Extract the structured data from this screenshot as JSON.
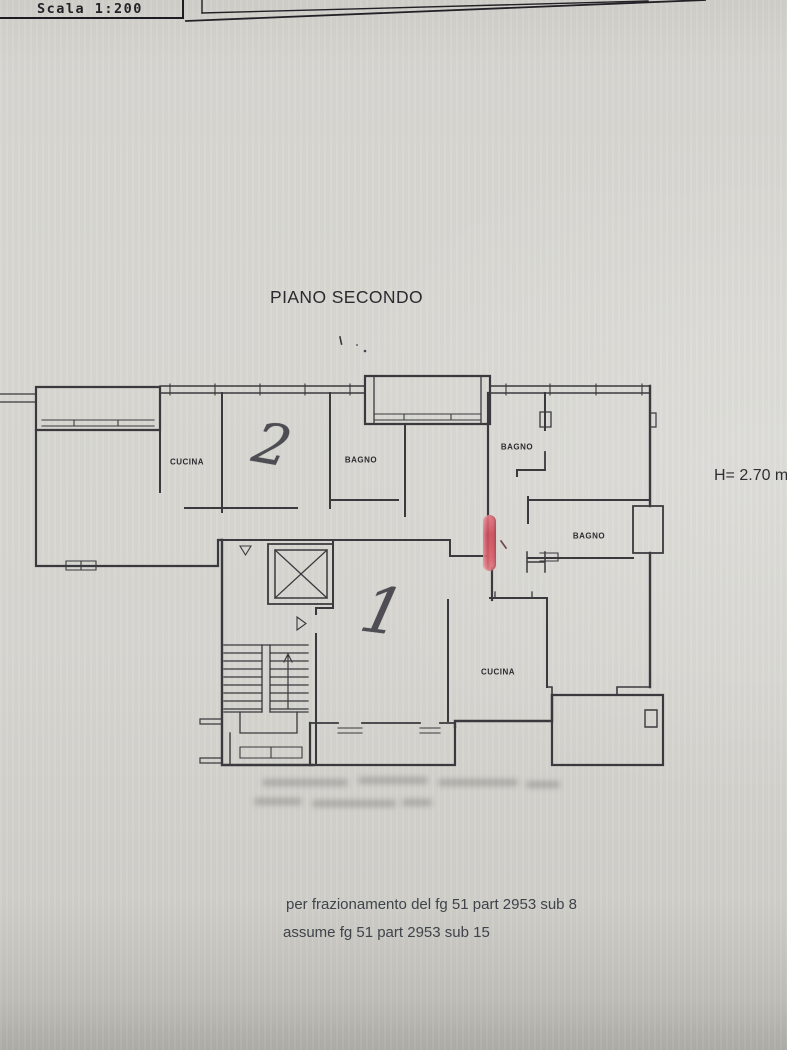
{
  "document": {
    "scale_label": "Scala 1:200",
    "floor_title": "PIANO SECONDO",
    "height_label": "H= 2.70 m",
    "notes": {
      "line1": "per frazionamento del fg 51 part 2953 sub 8",
      "line2": "assume fg 51 part 2953 sub 15"
    }
  },
  "plan": {
    "room_labels": [
      {
        "id": "cucina-apt2",
        "label": "CUCINA"
      },
      {
        "id": "bagno-apt2",
        "label": "BAGNO"
      },
      {
        "id": "bagno-small-apt1",
        "label": "BAGNO"
      },
      {
        "id": "bagno-right-apt1",
        "label": "BAGNO"
      },
      {
        "id": "cucina-apt1",
        "label": "CUCINA"
      }
    ],
    "unit_numbers": [
      {
        "id": "unit-2",
        "value": "2"
      },
      {
        "id": "unit-1",
        "value": "1"
      }
    ],
    "colors": {
      "wall_ink": "#3a3a3e",
      "red_highlight": "#d4556a",
      "paper": "#d6d5d0"
    }
  }
}
